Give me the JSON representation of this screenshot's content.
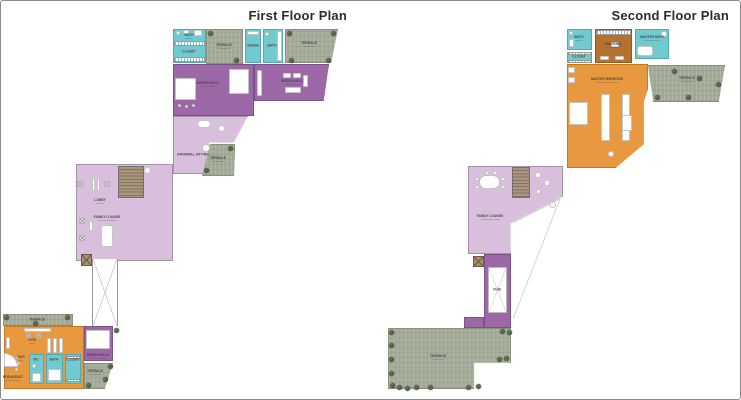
{
  "first_floor": {
    "title": "First Floor Plan",
    "rooms": {
      "bath_top": "BATH",
      "closet_top": "CLOSET",
      "terrace_top": "TERRACE",
      "sauna": "SAUNA",
      "bath_mid": "BATH",
      "terrace_top_right": "TERRACE",
      "bedroom_02": "BEDROOM 02",
      "bedroom_03": "BEDROOM 03",
      "informal_sitting": "INFORMAL SITTING",
      "terrace_mid": "TERRACE",
      "lobby": "LOBBY",
      "family_lounge": "FAMILY LOUNGE",
      "terrace_left": "TERRACE",
      "gym": "GYM",
      "bar": "BAR",
      "breakfast": "BREAKFAST",
      "wc": "WC",
      "bath_lower": "BATH",
      "closet_lower": "CLOSET",
      "bedroom_04": "BEDROOM 04",
      "terrace_bottom": "TERRACE"
    }
  },
  "second_floor": {
    "title": "Second Floor Plan",
    "rooms": {
      "bath": "BATH",
      "closet": "CLOSET",
      "dressing": "DRESSING",
      "master_bath": "MASTER BATH",
      "terrace_right": "TERRACE",
      "master_bedroom": "MASTER BEDROOM",
      "family_lounge": "FAMILY LOUNGE",
      "void": "VOID",
      "terrace_main": "TERRACE"
    }
  },
  "legend_colors": {
    "bedroom_purple": "#9c68a8",
    "sitting_lilac": "#d8c0dc",
    "bath_teal": "#70cad0",
    "gym_orange": "#e8993f",
    "dressing_brown": "#b5722f",
    "terrace_green": "#a3ab98",
    "stairs_tan": "#9a8871",
    "tree_green": "#45503c",
    "wall_grey": "#9a9a9a"
  }
}
